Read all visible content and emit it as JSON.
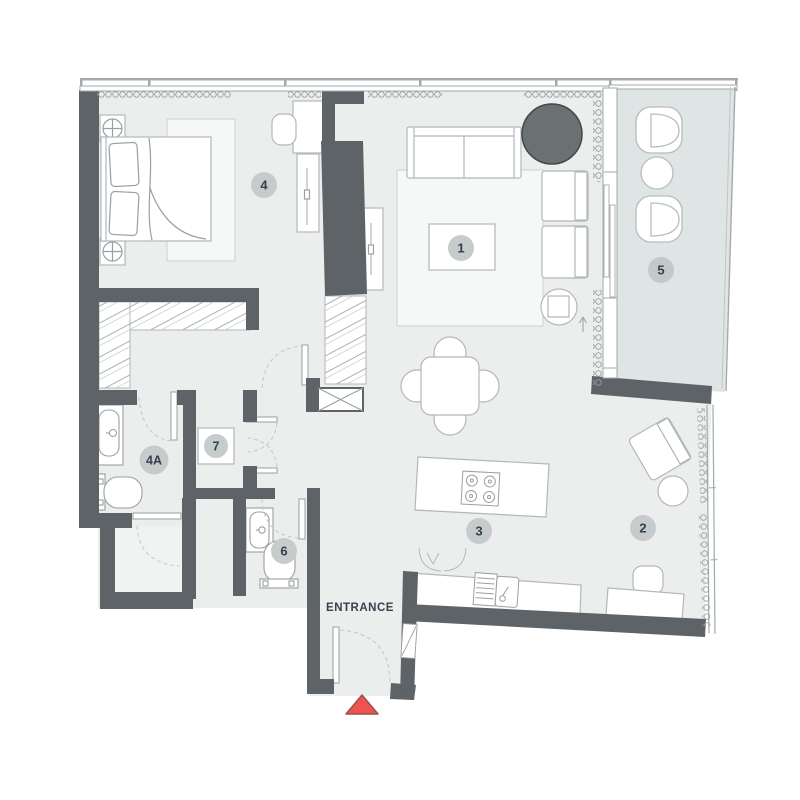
{
  "floor_plan": {
    "entrance_label": "ENTRANCE",
    "rooms": [
      {
        "key": "living-room",
        "label": "1"
      },
      {
        "key": "study-corner",
        "label": "2"
      },
      {
        "key": "kitchen",
        "label": "3"
      },
      {
        "key": "bedroom",
        "label": "4"
      },
      {
        "key": "bathroom-ensuite",
        "label": "4A"
      },
      {
        "key": "balcony",
        "label": "5"
      },
      {
        "key": "bathroom-guest",
        "label": "6"
      },
      {
        "key": "utility",
        "label": "7"
      }
    ],
    "colors": {
      "wall": "#5e6367",
      "floor": "#ebeeed",
      "balcony_floor": "#dee5e4",
      "rug": "#f6f7f7",
      "furniture_line": "#b2b8b8",
      "window_line": "#a3aaaa",
      "door_arc": "#c5cbcb",
      "label_badge": "#c6cccc",
      "label_text": "#34404f",
      "dark_accent": "#6b7073",
      "entrance_marker_fill": "#ef5350",
      "entrance_marker_stroke": "#9b504e"
    },
    "icons": {
      "entrance_marker": "triangle-up",
      "bedside_lamp": "circle-cross",
      "service_shaft": "x-box"
    }
  }
}
